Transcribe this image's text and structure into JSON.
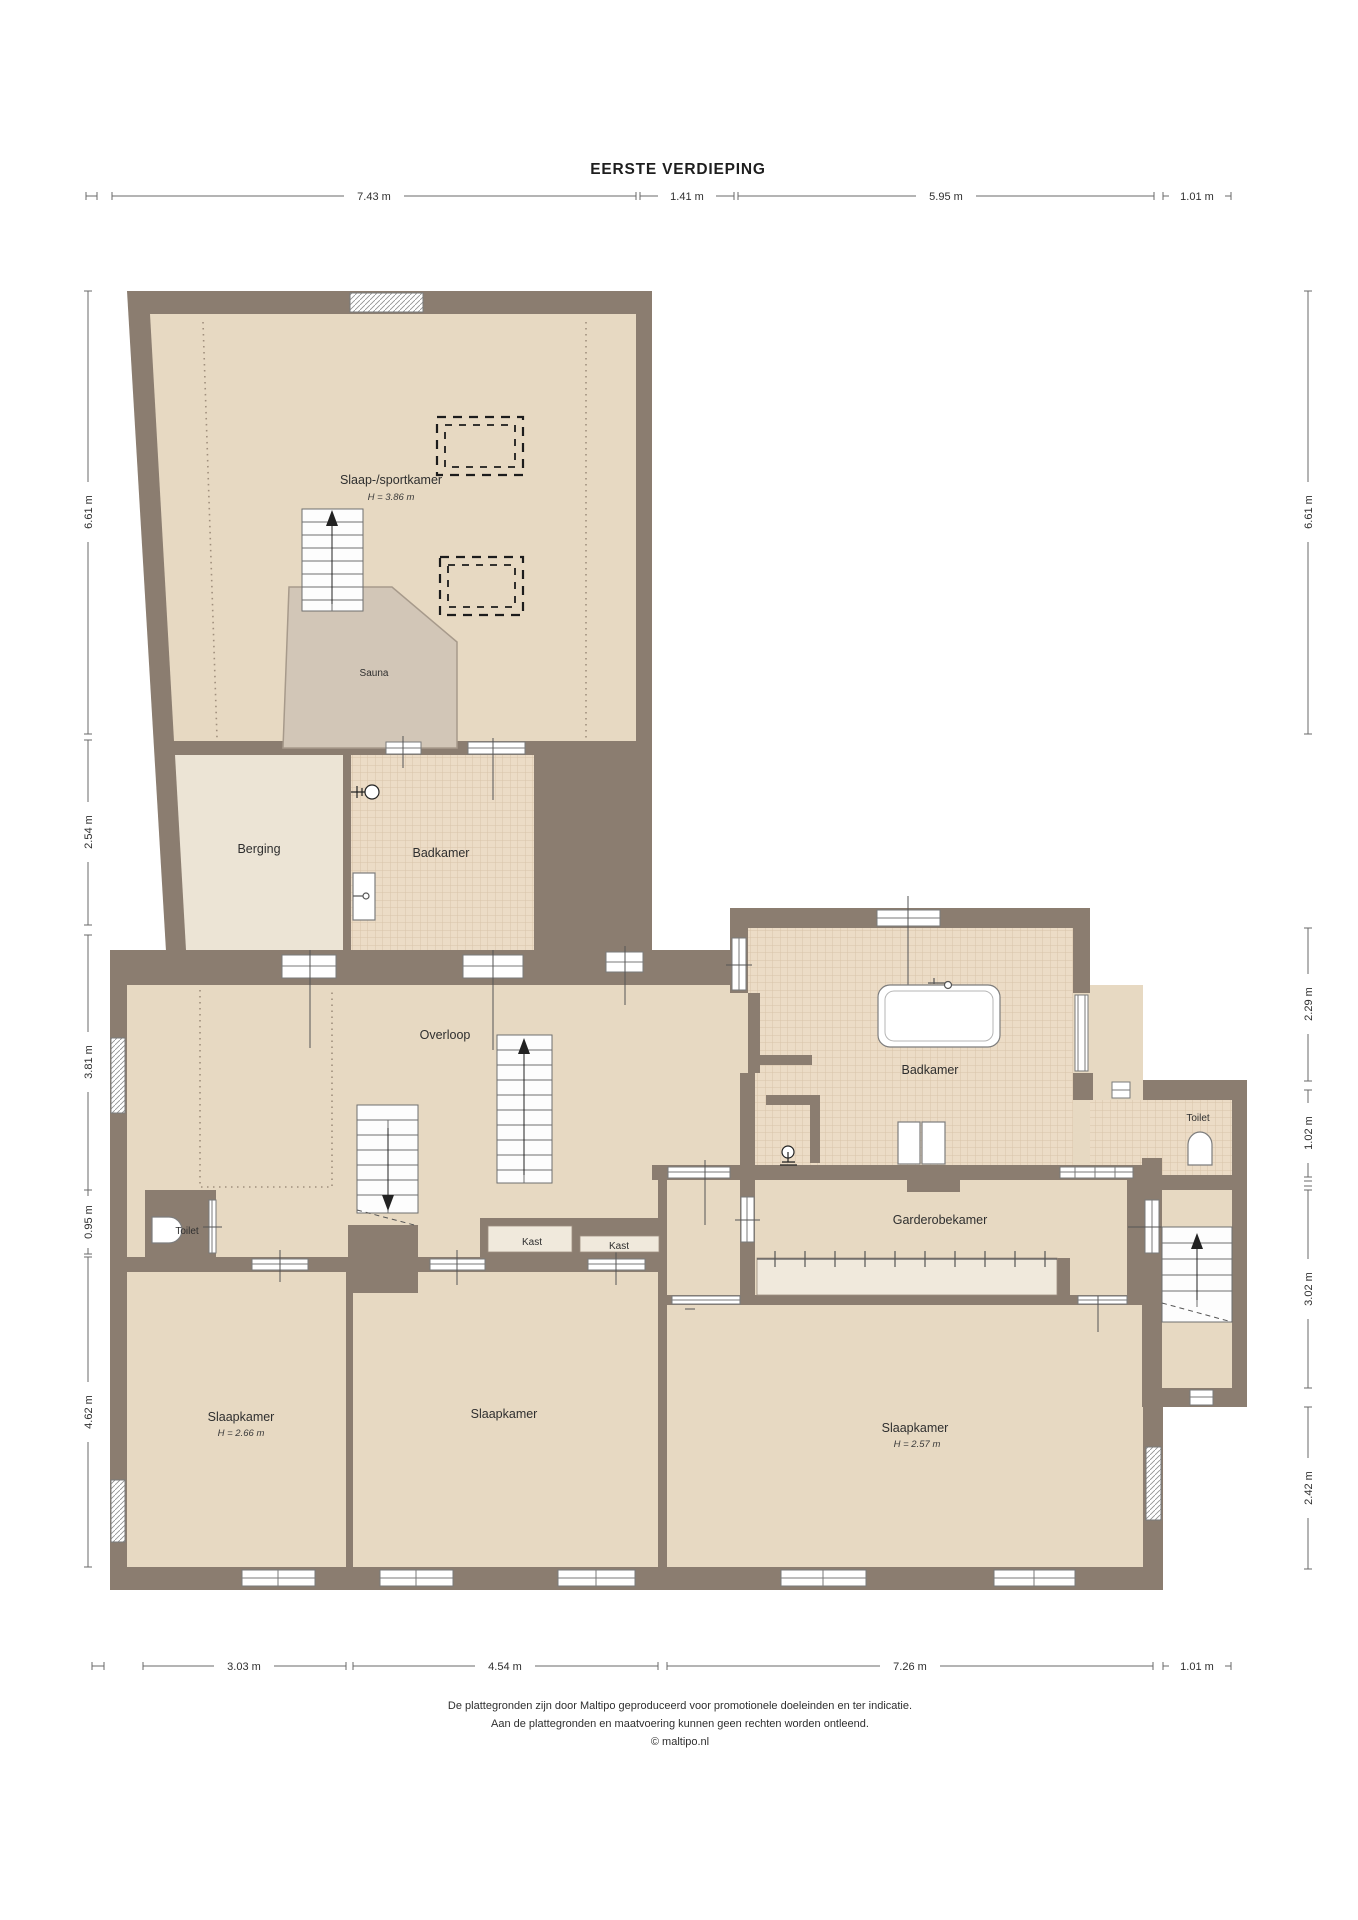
{
  "title": "EERSTE VERDIEPING",
  "rooms": {
    "sportkamer": {
      "label": "Slaap-/sportkamer",
      "height": "H = 3.86 m"
    },
    "sauna": {
      "label": "Sauna"
    },
    "berging": {
      "label": "Berging"
    },
    "badkamer_boven": {
      "label": "Badkamer"
    },
    "overloop": {
      "label": "Overloop"
    },
    "badkamer": {
      "label": "Badkamer"
    },
    "toilet_rechts": {
      "label": "Toilet"
    },
    "garderobekamer": {
      "label": "Garderobekamer"
    },
    "toilet_links": {
      "label": "Toilet"
    },
    "kast1": {
      "label": "Kast"
    },
    "kast2": {
      "label": "Kast"
    },
    "slaapkamer1": {
      "label": "Slaapkamer",
      "height": "H = 2.66 m"
    },
    "slaapkamer2": {
      "label": "Slaapkamer"
    },
    "slaapkamer3": {
      "label": "Slaapkamer",
      "height": "H = 2.57 m"
    }
  },
  "dimensions": {
    "top": [
      {
        "label": "7.43 m"
      },
      {
        "label": "1.41 m"
      },
      {
        "label": "5.95 m"
      },
      {
        "label": "1.01 m"
      }
    ],
    "bottom": [
      {
        "label": "3.03 m"
      },
      {
        "label": "4.54 m"
      },
      {
        "label": "7.26 m"
      },
      {
        "label": "1.01 m"
      }
    ],
    "left": [
      {
        "label": "6.61 m"
      },
      {
        "label": "2.54 m"
      },
      {
        "label": "3.81 m"
      },
      {
        "label": "0.95 m"
      },
      {
        "label": "4.62 m"
      }
    ],
    "right": [
      {
        "label": "6.61 m"
      },
      {
        "label": "2.29 m"
      },
      {
        "label": "1.02 m"
      },
      {
        "label": "3.02 m"
      },
      {
        "label": "2.42 m"
      }
    ]
  },
  "colors": {
    "wall": "#8b7d70",
    "floor": "#e7d9c2",
    "floor_light": "#ece4d5",
    "sauna": "#d2c6b7",
    "tile": "#ecdcc6",
    "closet": "#f0e9dc",
    "dim_line": "#6a6a6a"
  },
  "footer": {
    "line1": "De plattegronden zijn door Maltipo geproduceerd voor promotionele doeleinden en ter indicatie.",
    "line2": "Aan de plattegronden en maatvoering kunnen geen rechten worden ontleend.",
    "line3": "© maltipo.nl"
  }
}
